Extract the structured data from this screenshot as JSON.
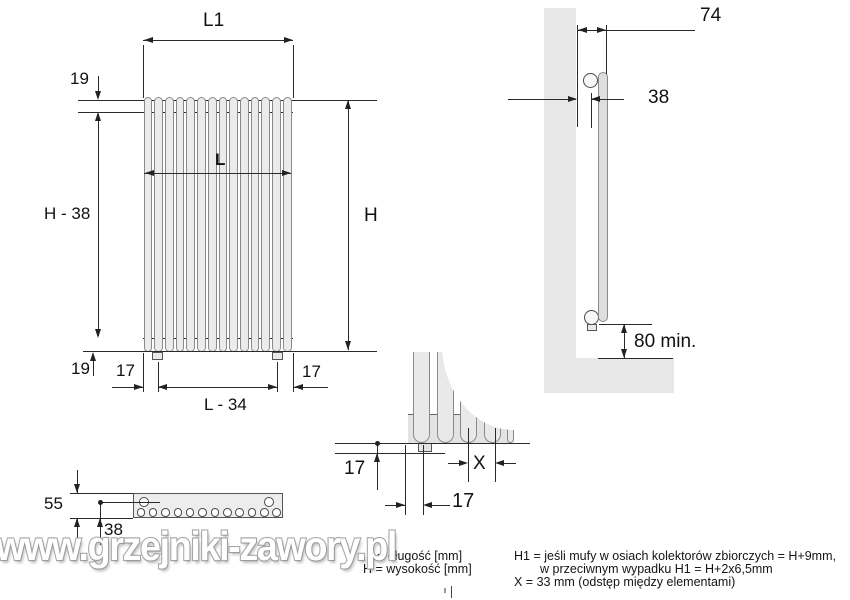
{
  "front_view": {
    "l1": "L1",
    "l": "L",
    "h": "H",
    "h_minus_38": "H - 38",
    "offset_top_19": "19",
    "offset_bottom_19": "19",
    "stub_left_17": "17",
    "stub_right_17": "17",
    "l_minus_34": "L - 34"
  },
  "side_view": {
    "depth_74": "74",
    "wall_axis_38": "38",
    "floor_clearance": "80 min."
  },
  "detail_view": {
    "vert_17": "17",
    "horiz_17": "17",
    "spacing_x": "X"
  },
  "top_view": {
    "depth_55": "55",
    "axis_38": "38"
  },
  "notes": {
    "l_note": "L = długość [mm]",
    "h_note": "H = wysokość [mm]",
    "h1_note_line1": "H1 = jeśli mufy w osiach kolektorów zbiorczych = H+9mm,",
    "h1_note_line2": "w przeciwnym wypadku H1 = H+2x6,5mm",
    "x_note": "X = 33 mm (odstęp między elementami)"
  },
  "watermark_text": "www.grzejniki-zawory.pl",
  "colors": {
    "line": "#2a2a2a",
    "radiator_fill": "#ebebeb",
    "wall_fill": "#e7e7e7",
    "watermark": "#a8a8a8"
  }
}
